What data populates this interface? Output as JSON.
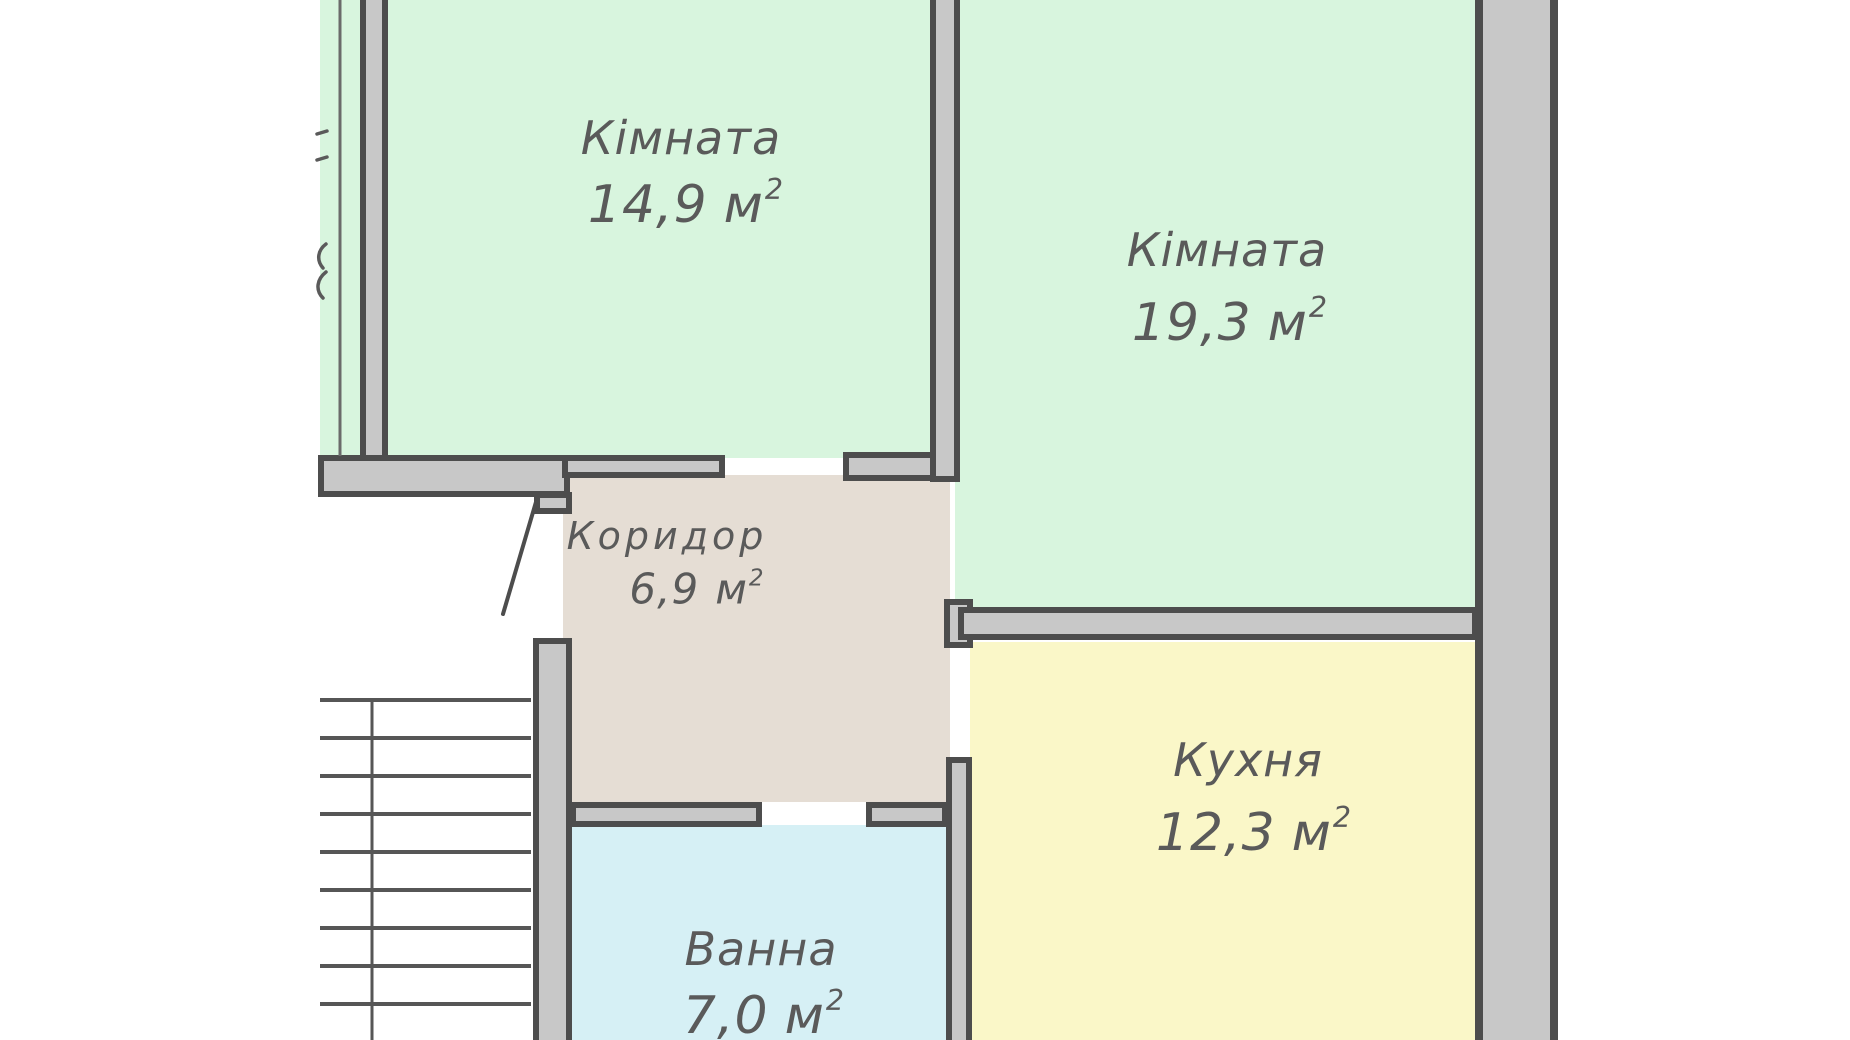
{
  "plan": {
    "rooms": [
      {
        "name": "Кімната",
        "area_value": "14,9",
        "area_unit": "м",
        "area_sup": "2",
        "fill": "#d8f5de"
      },
      {
        "name": "Кімната",
        "area_value": "19,3",
        "area_unit": "м",
        "area_sup": "2",
        "fill": "#d8f5de"
      },
      {
        "name": "Коридор",
        "area_value": "6,9",
        "area_unit": "м",
        "area_sup": "2",
        "fill": "#e5ddd4"
      },
      {
        "name": "Ванна",
        "area_value": "7,0",
        "area_unit": "м",
        "area_sup": "2",
        "fill": "#d6f0f5"
      },
      {
        "name": "Кухня",
        "area_value": "12,3",
        "area_unit": "м",
        "area_sup": "2",
        "fill": "#faf7c8"
      }
    ],
    "colors": {
      "background": "#ffffff",
      "wall_fill": "#c8c8c8",
      "wall_outline": "#4d4d4d",
      "label_text": "#5a5a5a",
      "stair_line": "#565656"
    }
  }
}
